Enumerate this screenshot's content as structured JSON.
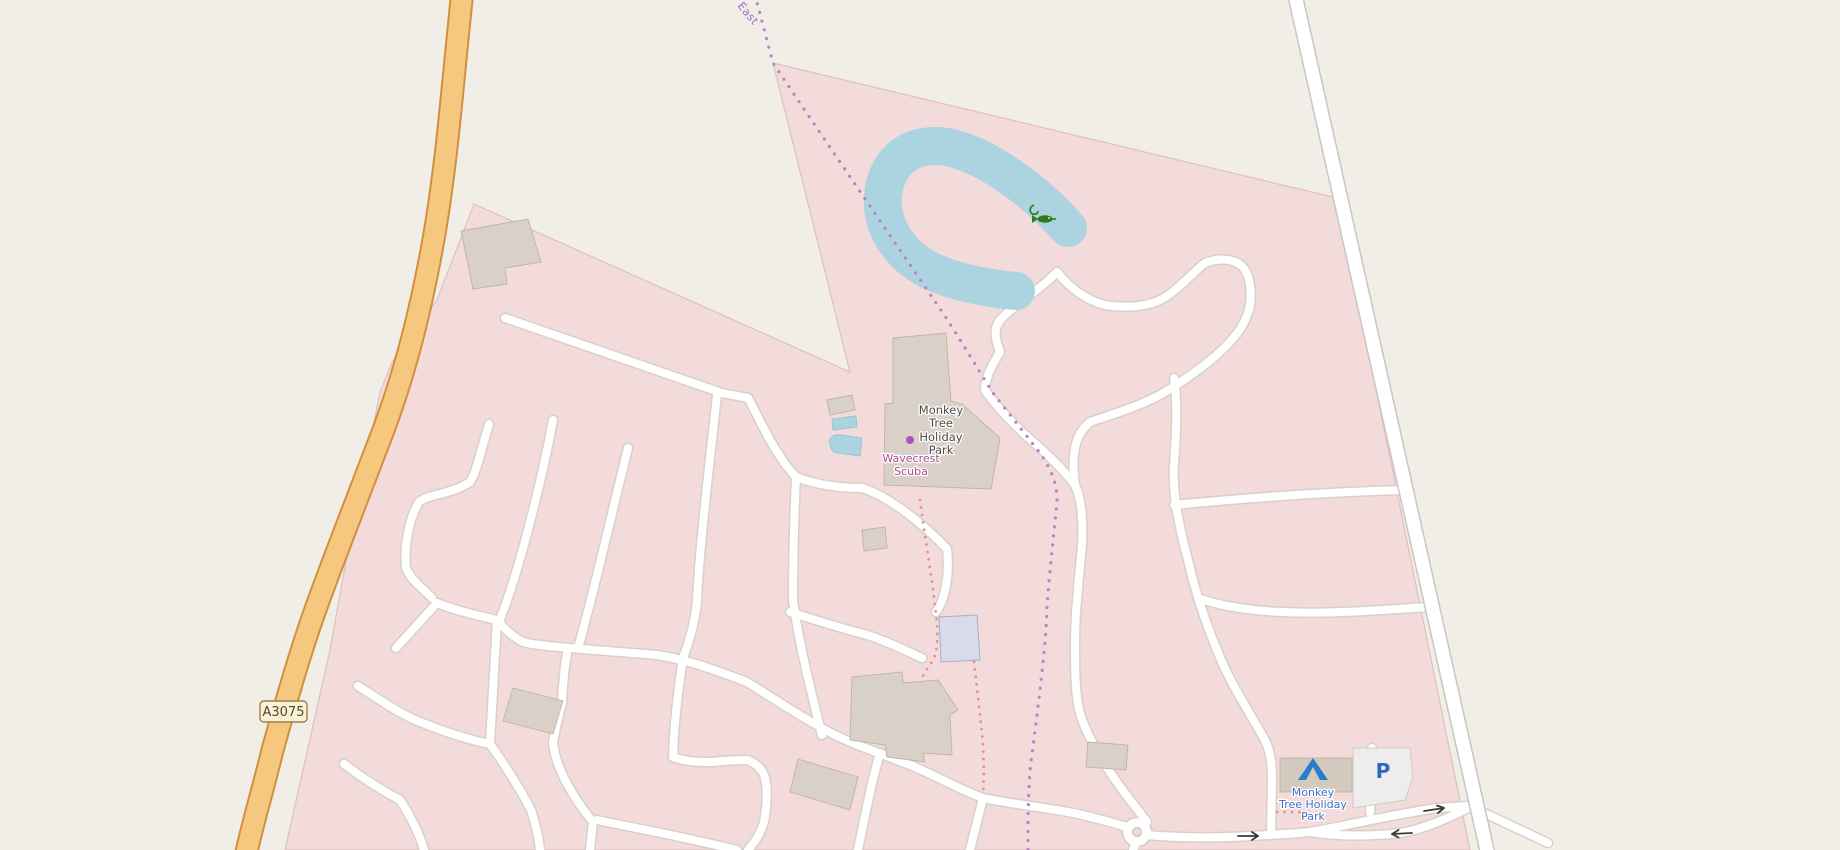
{
  "map": {
    "type": "openstreetmap-style rendered map",
    "labels": {
      "boundary_name_fragment": "East",
      "road_ref_badge": "A3075",
      "park_poi": {
        "line1": "Monkey",
        "line2": "Tree",
        "line3": "Holiday",
        "line4": "Park"
      },
      "scuba_poi": {
        "line1": "Wavecrest",
        "line2": "Scuba"
      },
      "campsite_label": {
        "line1": "Monkey",
        "line2": "Tree Holiday",
        "line3": "Park"
      },
      "parking_letter": "P"
    },
    "icons": {
      "campsite": "tent-icon",
      "parking": "parking-p-icon",
      "fishing": "fish-and-hook-icon",
      "poi": "poi-dot-icon",
      "oneway": "oneway-arrow-icon",
      "junction": "mini-roundabout"
    },
    "colors": {
      "beige_background": "#f1eee7",
      "campsite_area_pink": "#f2dbda",
      "area_border_pink": "#dfc0c0",
      "primary_road_fill": "#f6c87f",
      "primary_road_casing": "#d0903d",
      "minor_road_fill": "#ffffff",
      "minor_road_casing": "#d7d1ca",
      "main_road_casing": "#c9c5c0",
      "water_blue": "#abd4e0",
      "building_gray": "#d9d0c7",
      "building_tan": "#d3cabf",
      "special_building_lavender": "#d9dbea",
      "parking_area_gray": "#ededec",
      "boundary_purple": "#bd7fca",
      "path_red": "#e89090",
      "poi_dot_magenta": "#b04fbe",
      "park_label_gray": "#514a42",
      "shop_label_magenta": "#ac4a90",
      "tourism_label_blue": "#3f6fc6",
      "parking_icon_blue": "#2f66c6",
      "tent_icon_blue": "#2a7ccc",
      "fishing_icon_green": "#2d7a1e",
      "road_badge_bg": "#f8f0d8",
      "road_badge_border": "#9b8143",
      "road_badge_text": "#564a22",
      "oneway_arrow_dark": "#3a3a3a"
    }
  }
}
